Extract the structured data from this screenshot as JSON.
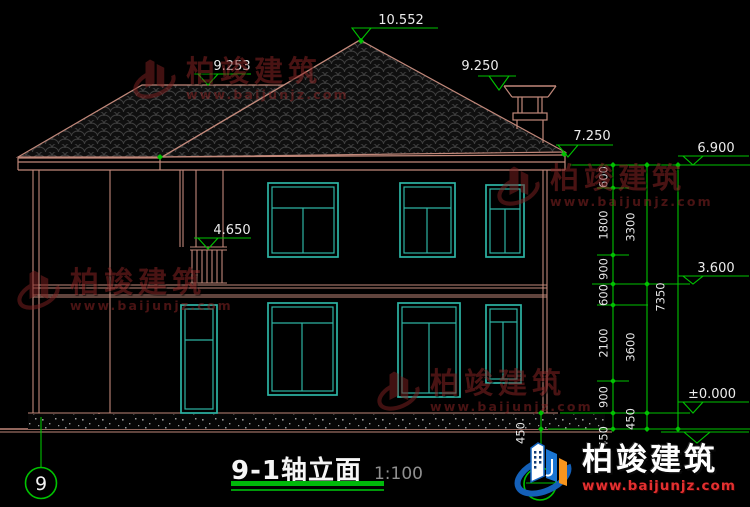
{
  "drawing": {
    "title": "9-1轴立面",
    "scale": "1:100",
    "axis_left_label": "9",
    "elevations": {
      "ridge": "10.552",
      "porch_roof": "9.253",
      "right_roof": "9.250",
      "eave": "7.250",
      "top_right": "6.900",
      "porch_balcony": "4.650",
      "floor2_right": "3.600",
      "ground": "±0.000"
    },
    "dim_col1": [
      "600",
      "1800",
      "900",
      "600",
      "2100",
      "900",
      "450"
    ],
    "dim_col2": [
      "3300",
      "3600",
      "450"
    ],
    "dim_col3": [
      "7350"
    ],
    "dim_wall_base": "450"
  },
  "watermark": {
    "name": "柏竣建筑",
    "url": "www.baijunjz.com"
  },
  "brand": {
    "name": "柏竣建筑",
    "url": "www.baijunjz.com"
  },
  "colors": {
    "line": "#c1887a",
    "window": "#2db4a4",
    "dim_green": "#00c200",
    "watermark_red": "#8c2626",
    "brand_blue": "#1a75d2",
    "brand_orange": "#f7941d",
    "url_red": "#e33030",
    "background": "#000000"
  }
}
